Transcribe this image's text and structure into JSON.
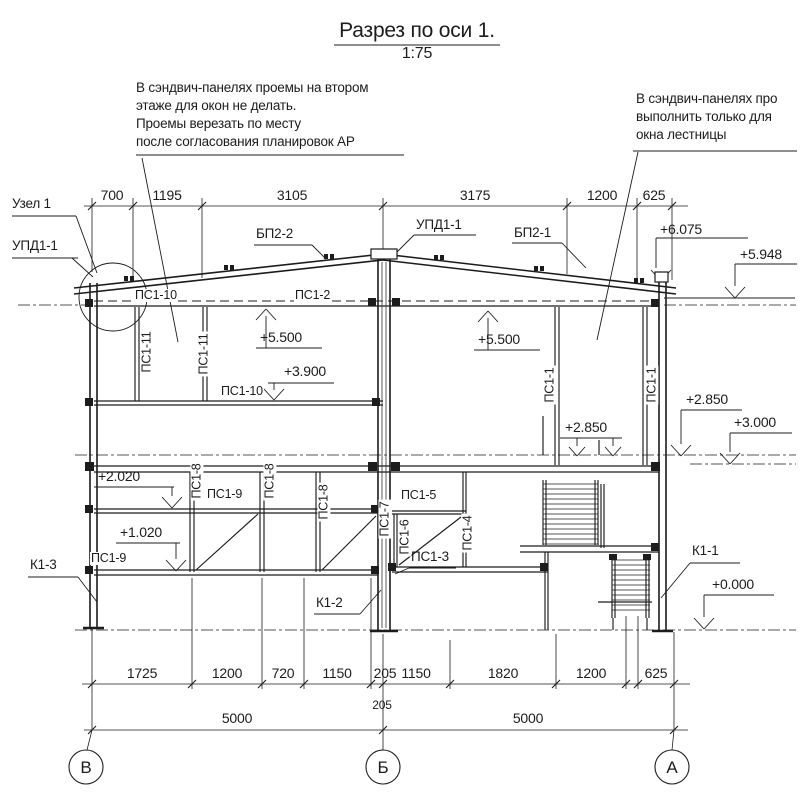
{
  "title": {
    "text": "Разрез по оси 1.",
    "scale": "1:75"
  },
  "notes": {
    "left": [
      "В сэндвич-панелях проемы на втором",
      "этаже для окон не делать.",
      "Проемы верезать по месту",
      "после согласования планировок АР"
    ],
    "right": [
      "В сэндвич-панелях про",
      "выполнить только для",
      "окна лестницы"
    ]
  },
  "dims": {
    "top": [
      "700",
      "1195",
      "3105",
      "3175",
      "1200",
      "625"
    ],
    "row1": [
      "1725",
      "1200",
      "720",
      "1150",
      "205",
      "1150",
      "1820",
      "1200",
      "625"
    ],
    "row2": [
      "5000",
      "205",
      "5000"
    ]
  },
  "levels": {
    "p6075": "+6.075",
    "p5948": "+5.948",
    "p5500_left": "+5.500",
    "p3900": "+3.900",
    "p5500_right": "+5.500",
    "p2850_inner": "+2.850",
    "p2850_outer": "+2.850",
    "p3000": "+3.000",
    "p2020": "+2.020",
    "p1020": "+1.020",
    "p0000": "+0.000"
  },
  "marks": {
    "uzel1": "Узел 1",
    "upd11_left": "УПД1-1",
    "upd11_ridge": "УПД1-1",
    "bp22": "БП2-2",
    "bp21": "БП2-1",
    "ps1_10_top": "ПС1-10",
    "ps1_2": "ПС1-2",
    "ps1_11_a": "ПС1-11",
    "ps1_11_b": "ПС1-11",
    "ps1_10_mid": "ПС1-10",
    "ps1_1_a": "ПС1-1",
    "ps1_1_b": "ПС1-1",
    "ps1_8_a": "ПС1-8",
    "ps1_8_b": "ПС1-8",
    "ps1_8_c": "ПС1-8",
    "ps1_9_top": "ПС1-9",
    "ps1_9_bottom": "ПС1-9",
    "ps1_5": "ПС1-5",
    "ps1_7": "ПС1-7",
    "ps1_6": "ПС1-6",
    "ps1_4": "ПС1-4",
    "ps1_3": "ПС1-3",
    "k1_1": "К1-1",
    "k1_2": "К1-2",
    "k1_3": "К1-3"
  },
  "axes": [
    "В",
    "Б",
    "А"
  ]
}
